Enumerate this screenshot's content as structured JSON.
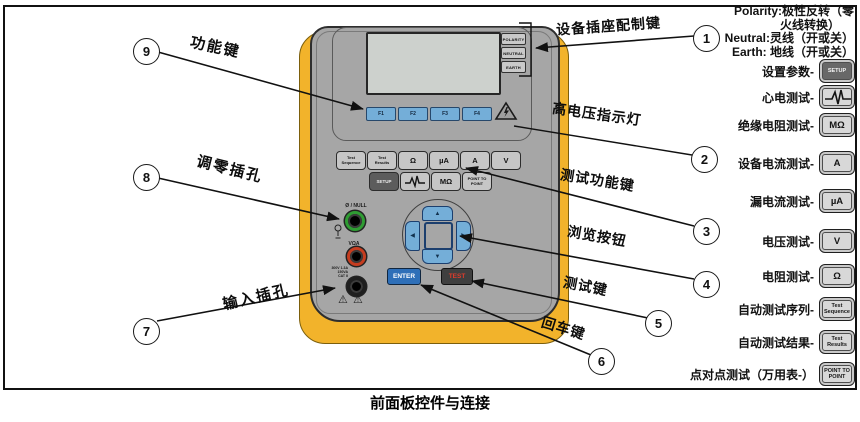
{
  "caption": "前面板控件与连接",
  "legend_top": {
    "line1": "Polarity:极性反转（零",
    "line2": "火线转换）",
    "line3": "Neutral:灵线（开或关）",
    "line4": "Earth: 地线（开或关）"
  },
  "right_legend": [
    {
      "label": "设置参数-",
      "key": "SETUP"
    },
    {
      "label": "心电测试-",
      "key": ""
    },
    {
      "label": "绝缘电阻测试-",
      "key": "MΩ"
    },
    {
      "label": "设备电流测试-",
      "key": "A"
    },
    {
      "label": "漏电流测试-",
      "key": "µA"
    },
    {
      "label": "电压测试-",
      "key": "V"
    },
    {
      "label": "电阻测试-",
      "key": "Ω"
    },
    {
      "label": "自动测试序列-",
      "key": "Test\nSequence"
    },
    {
      "label": "自动测试结果-",
      "key": "Test\nResults"
    },
    {
      "label": "点对点测试（万用表-）",
      "key": "POINT TO\nPOINT"
    }
  ],
  "callouts": [
    {
      "number": "1",
      "label": "设备插座配制键"
    },
    {
      "number": "2",
      "label": "高电压指示灯"
    },
    {
      "number": "3",
      "label": "测试功能键"
    },
    {
      "number": "4",
      "label": "浏览按钮"
    },
    {
      "number": "5",
      "label": "测试键"
    },
    {
      "number": "6",
      "label": "回车键"
    },
    {
      "number": "7",
      "label": "输入插孔"
    },
    {
      "number": "8",
      "label": "调零插孔"
    },
    {
      "number": "9",
      "label": "功能键"
    }
  ],
  "device": {
    "outlet_keys": [
      "POLARITY",
      "NEUTRAL",
      "EARTH"
    ],
    "function_keys": [
      "F1",
      "F2",
      "F3",
      "F4"
    ],
    "test_keys_row1": [
      "Test\nSequence",
      "Test\nResults",
      "Ω",
      "µA",
      "A",
      "V"
    ],
    "test_keys_row2": [
      "SETUP",
      "",
      "MΩ",
      "POINT TO\nPOINT"
    ],
    "enter_key": "ENTER",
    "test_key": "TEST",
    "null_jack_label": "Ø / NULL",
    "vohm_jack_label": "VΩA",
    "jack_rating": "300V 1.3A 150VA\nCAT II"
  },
  "icons": {
    "ecg_key": "ecg-waveform",
    "high_voltage_indicator": "warning-triangle",
    "null_probe": "probe",
    "caution_marks": "warning-triangle"
  }
}
